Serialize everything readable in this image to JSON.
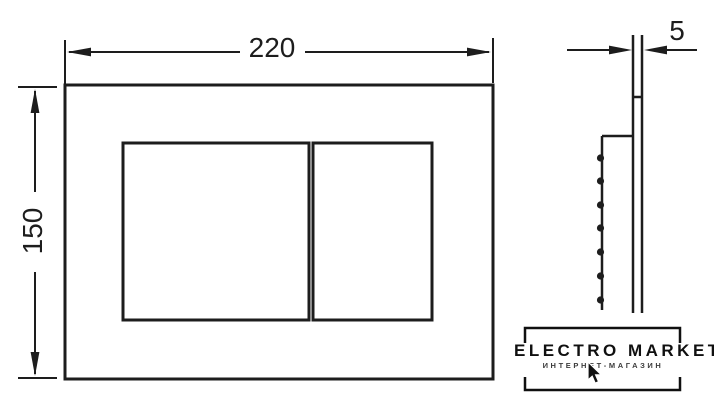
{
  "drawing": {
    "title": "flush-plate-technical-drawing",
    "dimensions": {
      "width": "220",
      "height": "150",
      "thickness": "5"
    },
    "views": {
      "front": "plate-with-two-buttons",
      "side": "plate-profile-with-serrated-frame"
    }
  },
  "watermark": {
    "brand": "ELECTRO MARKET",
    "tagline": "ИНТЕРНЕТ-МАГАЗИН",
    "cursor_icon": "mouse-pointer-icon"
  },
  "colors": {
    "line": "#1d1d1d",
    "logo": "#101010",
    "background": "#ffffff"
  }
}
